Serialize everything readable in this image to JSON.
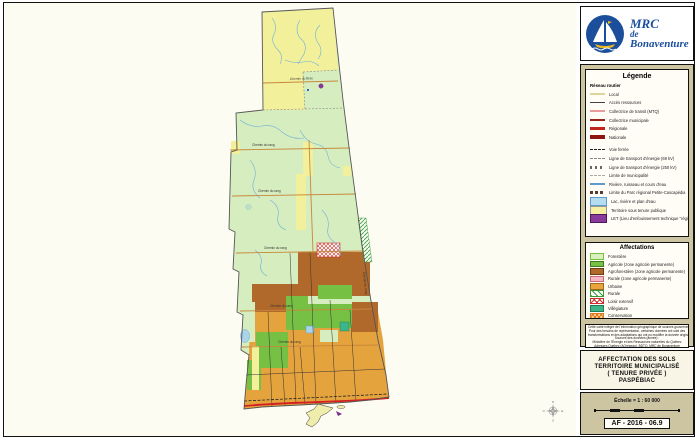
{
  "logo": {
    "line1": "MRC",
    "line2": "de",
    "line3": "Bonaventure"
  },
  "legend": {
    "title": "Légende",
    "roads_heading": "Réseau routier",
    "road_items": [
      {
        "label": "Local",
        "swatch": "local"
      },
      {
        "label": "Accès ressources",
        "swatch": "acces"
      },
      {
        "label": "Collectrice de transit (MTQ)",
        "swatch": "coltransit"
      },
      {
        "label": "Collectrice municipale",
        "swatch": "colmun"
      },
      {
        "label": "Régionale",
        "swatch": "regionale"
      },
      {
        "label": "Nationale",
        "swatch": "nationale"
      }
    ],
    "line_items": [
      {
        "label": "Voie ferrée",
        "swatch": "ferree"
      },
      {
        "label": "Ligne de transport d'énergie (69 kV)",
        "swatch": "e69"
      },
      {
        "label": "Ligne de transport d'énergie (250 kV)",
        "swatch": "e250"
      },
      {
        "label": "Limite de municipalité",
        "swatch": "limitemun"
      },
      {
        "label": "Rivière, ruisseau et cours d'eau",
        "swatch": "riviere"
      },
      {
        "label": "Limite du Parc régional Petite-Cascapédia",
        "swatch": "parc"
      },
      {
        "label": "Lac, rivière et plan d'eau",
        "swatch": "lac"
      },
      {
        "label": "Territoire sous tenure publique",
        "swatch": "tenure"
      },
      {
        "label": "LET (Lieu d'enfouissement technique \"régional\")",
        "swatch": "let"
      }
    ]
  },
  "affectations": {
    "title": "Affectations",
    "items": [
      {
        "label": "Forestière",
        "swatch": "forestiere",
        "color": "#d9efbe"
      },
      {
        "label": "Agricole (zone agricole permanente)",
        "swatch": "agricole",
        "color": "#76c043"
      },
      {
        "label": "Agroforestière (zone agricole permanente)",
        "swatch": "agroforestiere",
        "color": "#b0692b"
      },
      {
        "label": "Rurale (zone agricole permanente)",
        "swatch": "ruralezap",
        "color": "#f6b8c4"
      },
      {
        "label": "Urbaine",
        "swatch": "urbaine",
        "color": "#e9a43d"
      },
      {
        "label": "Rurale",
        "swatch": "rurale",
        "pattern": "green-diagonal-hatch"
      },
      {
        "label": "Loisir extensif",
        "swatch": "loisir",
        "pattern": "red-cross-hatch"
      },
      {
        "label": "Villégiature",
        "swatch": "villegiature",
        "color": "#3eb489"
      },
      {
        "label": "Conservation",
        "swatch": "conservation",
        "pattern": "orange-cross-hatch"
      }
    ]
  },
  "disclaimer": {
    "lines": [
      "Cette carte intègre de l'information géographique de sources gouvernementales.",
      "Pour des besoins de représentation, certaines données ont subi des",
      "transformations et des adaptations qui ont pu modifier la donnée originale.",
      "Sources des données (année) :",
      "Ministère de l'Énergie et des Ressources naturelles du Québec",
      "Adresses Québec (AQréseau), BDTQ, MRC de Bonaventure",
      "MRC de Bonaventure, service de géomatique, janvier 2016"
    ]
  },
  "title_block": {
    "line1": "AFFECTATION DES SOLS",
    "line2": "TERRITOIRE MUNICIPALISÉ",
    "line3": "( TENURE PRIVÉE )",
    "line4": "PASPÉBIAC"
  },
  "scale_block": {
    "scale_text": "Échelle = 1 : 60 000",
    "sheet_code": "AF - 2016 - 06.9"
  },
  "map": {
    "road_labels": {
      "main": "Chemin du Bras",
      "generic": "Chemin du rang"
    },
    "compass": {
      "n": "N",
      "e": "E",
      "s": "S",
      "w": "O"
    }
  }
}
